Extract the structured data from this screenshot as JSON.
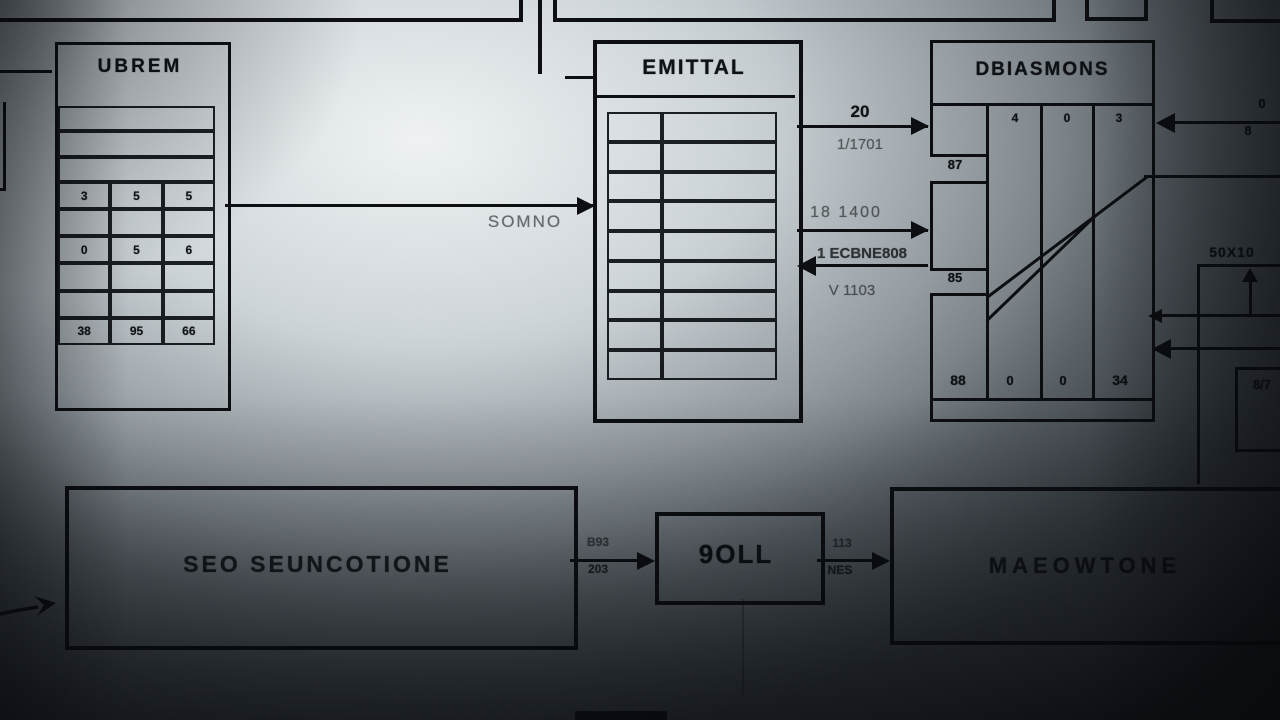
{
  "colors": {
    "line": "#0c0e11",
    "bg_light": "#eef2f4",
    "bg_dark": "#1a1f24"
  },
  "diagram": {
    "ubrem": {
      "title": "UBREM",
      "table": {
        "grid_rows": [
          [
            "3",
            "5",
            "5"
          ],
          [
            "",
            "",
            ""
          ],
          [
            "0",
            "5",
            "6"
          ],
          [
            "",
            "",
            ""
          ],
          [
            "",
            "",
            ""
          ],
          [
            "38",
            "95",
            "66"
          ]
        ]
      }
    },
    "emittal": {
      "title": "EMITTAL"
    },
    "dbiasmons": {
      "title": "DBIASMONS",
      "top_values": [
        "4",
        "0",
        "3"
      ],
      "segment_labels": [
        "87",
        "85"
      ],
      "bottom_values": [
        "88",
        "0",
        "0",
        "34"
      ]
    },
    "seo": {
      "title": "SEO SEUNCOTIONE"
    },
    "soll": {
      "title": "9OLL"
    },
    "maeowtone": {
      "title": "MAEOWTONE"
    },
    "labels": {
      "ubrem_to_emittal": "SOMNO",
      "emittal_to_dbiasmons_1_top": "20",
      "emittal_to_dbiasmons_1_bottom": "1/1701",
      "emittal_to_dbiasmons_2": "18 1400",
      "dbiasmons_to_emittal_top": "1 ECBNE808",
      "dbiasmons_to_emittal_bottom": "V 1103",
      "right_arrow_top": "0",
      "right_arrow_bottom": "8",
      "right_box_label": "50X10",
      "right_lower_box_label": "8/7",
      "seo_to_soll_top": "B93",
      "seo_to_soll_bottom": "203",
      "soll_to_maeowtone_top": "113",
      "soll_to_maeowtone_bottom": "NES"
    }
  }
}
